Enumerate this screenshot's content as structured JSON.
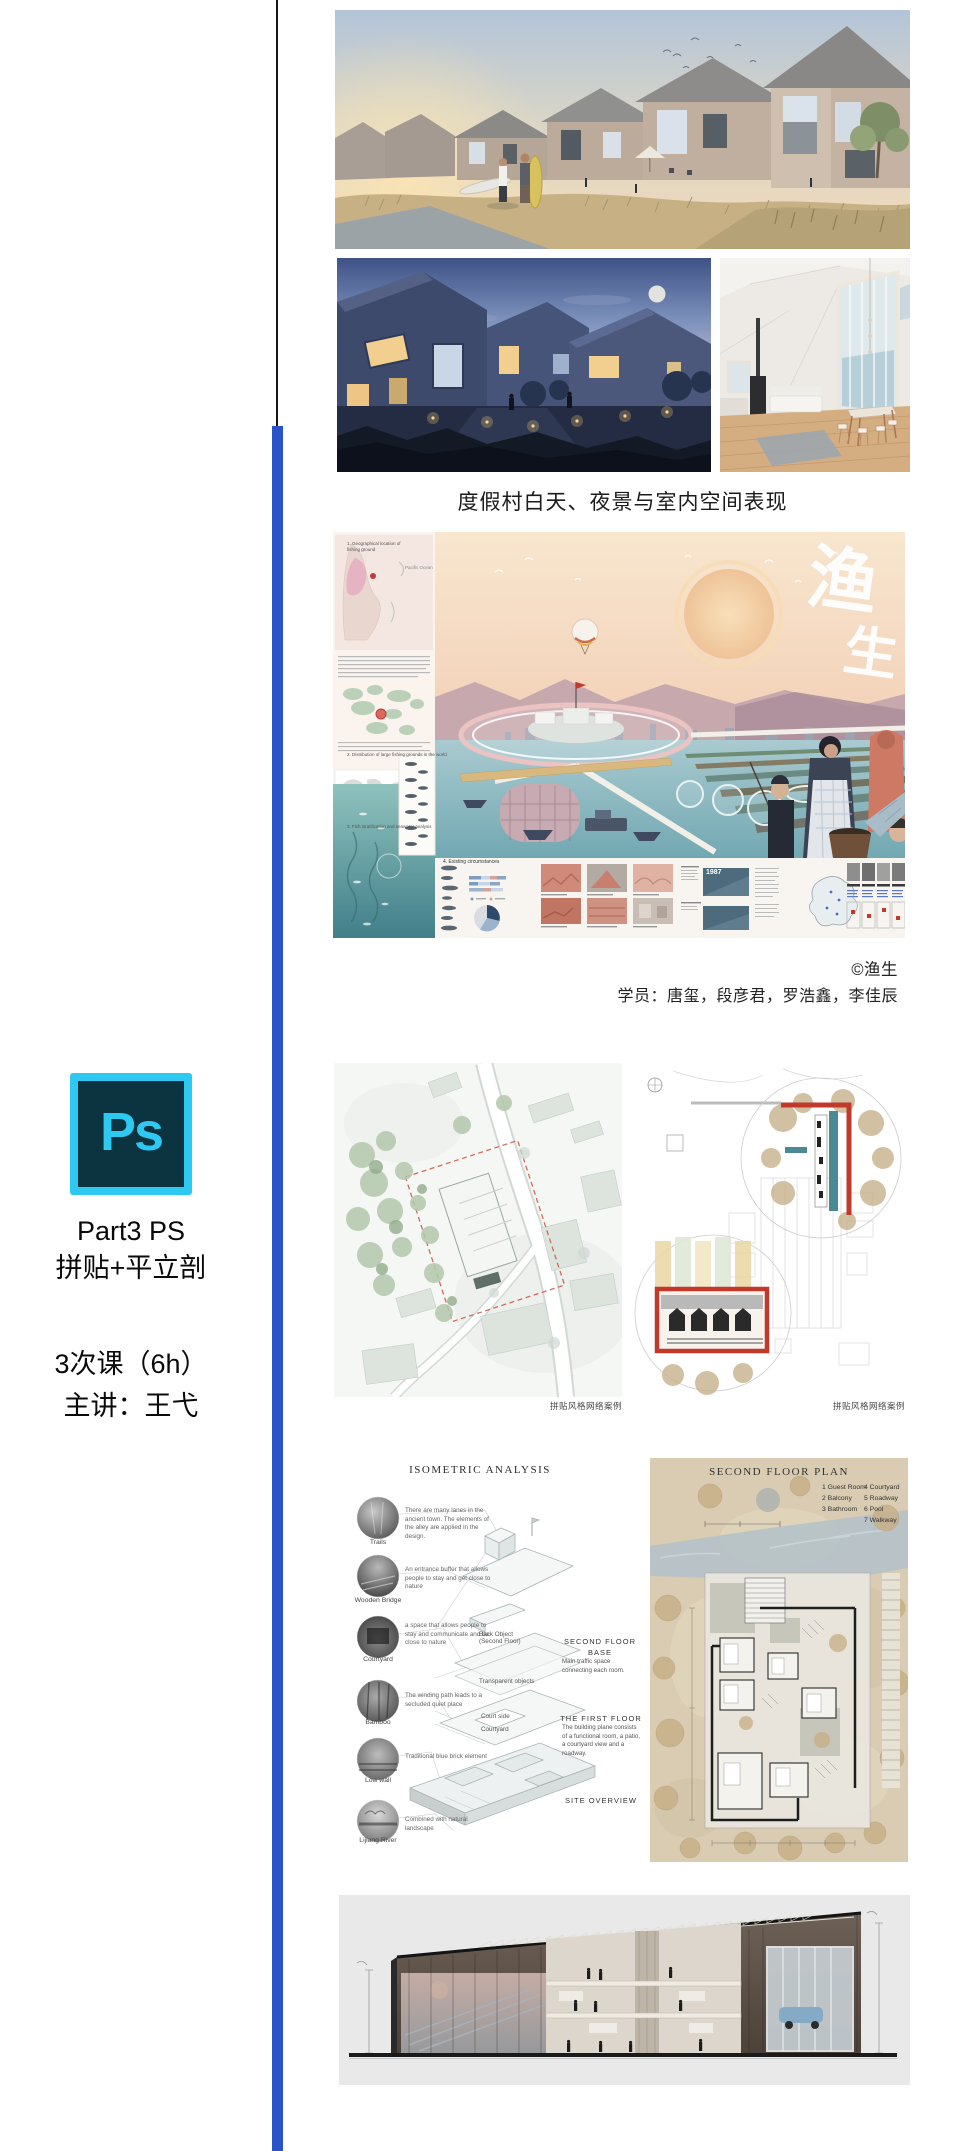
{
  "page": {
    "accent_blue": "#2B53C8",
    "divider_black": "#161616",
    "background": "#FFFFFF"
  },
  "gallery": {
    "caption": "度假村白天、夜景与室内空间表现",
    "credit": "©渔生",
    "students": "学员：唐玺，段彦君，罗浩鑫，李佳辰",
    "siteplan_caption_left": "拼贴风格网络案例",
    "siteplan_caption_right": "拼贴风格网络案例"
  },
  "poster": {
    "calligraphy_char1": "渔",
    "calligraphy_char2": "生",
    "map_label": "Pacific Ocean",
    "year_label": "1987",
    "sections": {
      "s1": "1. Geographical location of fishing ground",
      "s2": "2. Distribution of large fishing grounds in the world",
      "s3": "3. Fish stratification and seawater analysis",
      "s4": "4. Existing circumstances"
    }
  },
  "course": {
    "logo": "Ps",
    "part": "Part3 PS",
    "topic": "拼贴+平立剖",
    "sessions": "3次课（6h）",
    "teacher": "主讲：王弋",
    "logo_colors": {
      "bg": "#0C3340",
      "accent": "#2EC9F0"
    }
  },
  "isometric": {
    "title": "ISOMETRIC ANALYSIS",
    "items": [
      {
        "label": "Trails",
        "note": "There are many lanes in the ancient town. The elements of the alley are applied in the design."
      },
      {
        "label": "Wooden Bridge",
        "note": "An entrance buffer that allows people to stay and get close to nature"
      },
      {
        "label": "Courtyard",
        "note": "a space that allows people to stay and communicate and be close to nature"
      },
      {
        "label": "Bamboo",
        "note": "The winding path leads to a secluded quiet place"
      },
      {
        "label": "Low wall",
        "note": "Traditional blue brick element"
      },
      {
        "label": "Lijiang River",
        "note": "Combined with natural landscape"
      }
    ],
    "axon": {
      "l1a": "Back Object",
      "l1b": "(Second Floor)",
      "l2": "Transparent objects",
      "l3": "Court side",
      "l4": "Courtyard"
    },
    "blocks": {
      "b1_heading1": "SECOND FLOOR",
      "b1_heading2": "BASE",
      "b1_body": "Main traffic space connecting each room.",
      "b2_heading": "THE FIRST FLOOR",
      "b2_body": "The building plane consists of a functional room, a patio, a courtyard view and a roadway.",
      "b3_heading": "SITE OVERVIEW"
    }
  },
  "floorplan": {
    "title": "SECOND FLOOR PLAN",
    "legend": [
      "1 Guest Room",
      "2 Balcony",
      "3 Bathroom",
      "4 Courtyard",
      "5 Roadway",
      "6 Pool",
      "7 Walkway"
    ]
  }
}
